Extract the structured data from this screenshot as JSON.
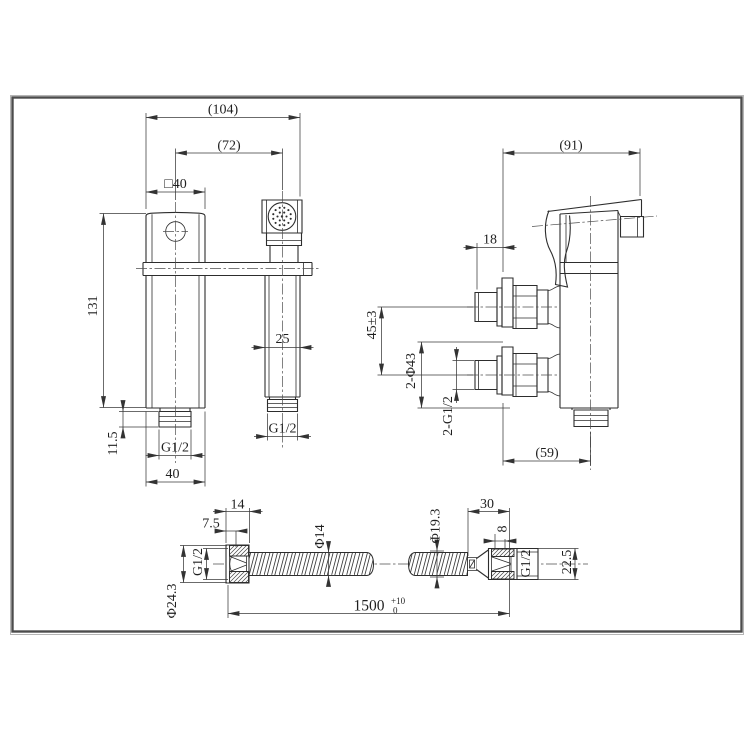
{
  "drawing": {
    "frame_color": "#4c4c4c",
    "line_color": "#2d2d2d",
    "front_view": {
      "overall_width": "(104)",
      "hole_centers": "(72)",
      "body_square": "□40",
      "body_height": "131",
      "shank_length": "11.5",
      "shank_thread_left": "G1/2",
      "base_width": "40",
      "spout_width": "25",
      "shank_thread_right": "G1/2"
    },
    "side_view": {
      "overall_depth": "(91)",
      "inlet_projection": "18",
      "inlet_centers": "45±3",
      "flange_diameter": "2-Φ43",
      "inlet_threads": "2-G1/2",
      "body_offset": "(59)"
    },
    "hose_view": {
      "nut_length": "14",
      "cone_depth": "7.5",
      "thread_left": "G1/2",
      "nut_diameter": "Φ24.3",
      "hose_diameter": "Φ14",
      "hose_outer_diameter": "Φ19.3",
      "fitting_length": "30",
      "thread_length": "8",
      "thread_right": "G1/2",
      "fitting_diameter": "22.5",
      "hose_length": "1500",
      "hose_length_tol_upper": "+10",
      "hose_length_tol_lower": "0"
    }
  }
}
